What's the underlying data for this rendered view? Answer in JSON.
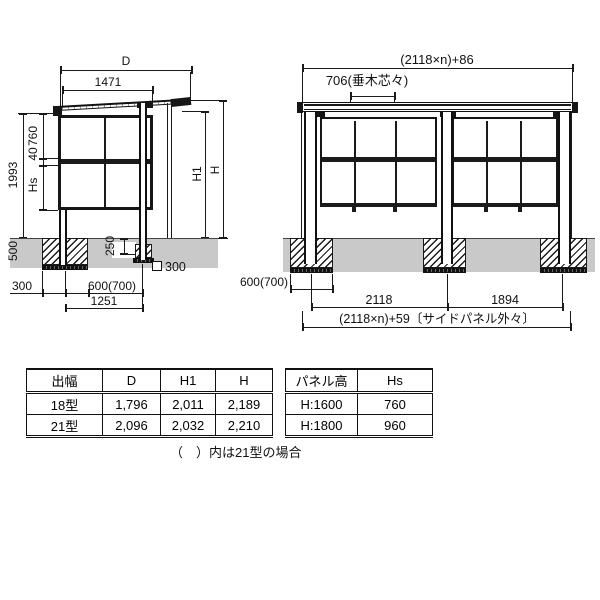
{
  "side_view": {
    "dim_d": "D",
    "dim_1471": "1471",
    "dim_1993": "1993",
    "dim_760": "760",
    "dim_40": "40",
    "dim_hs": "Hs",
    "dim_h1": "H1",
    "dim_h": "H",
    "dim_500": "500",
    "dim_250": "250",
    "dim_sq300": "300",
    "dim_300": "300",
    "dim_600_700": "600(700)",
    "dim_1251": "1251"
  },
  "front_view": {
    "dim_width_total_top": "(2118×n)+86",
    "dim_706": "706(垂木芯々)",
    "dim_600_700": "600(700)",
    "dim_2118": "2118",
    "dim_1894": "1894",
    "dim_width_total_bottom": "(2118×n)+59〔サイドパネル外々〕"
  },
  "spec_table": {
    "headers": [
      "出幅",
      "D",
      "H1",
      "H"
    ],
    "rows": [
      [
        "18型",
        "1,796",
        "2,011",
        "2,189"
      ],
      [
        "21型",
        "2,096",
        "2,032",
        "2,210"
      ]
    ]
  },
  "panel_table": {
    "headers": [
      "パネル高",
      "Hs"
    ],
    "rows": [
      [
        "H:1600",
        "760"
      ],
      [
        "H:1800",
        "960"
      ]
    ]
  },
  "note": "（　）内は21型の場合"
}
